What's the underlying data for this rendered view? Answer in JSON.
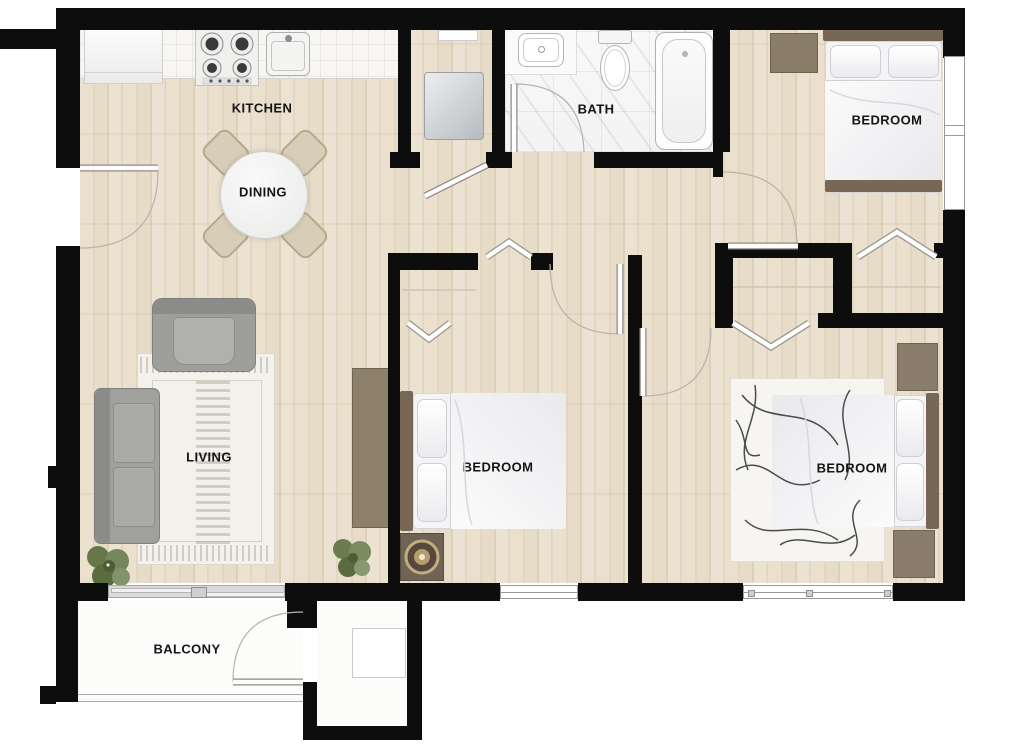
{
  "plan": {
    "type": "apartment-floor-plan",
    "rooms": {
      "kitchen": {
        "label": "KITCHEN"
      },
      "dining": {
        "label": "DINING"
      },
      "bath": {
        "label": "BATH"
      },
      "living": {
        "label": "LIVING"
      },
      "balcony": {
        "label": "BALCONY"
      },
      "bedroom_top": {
        "label": "BEDROOM"
      },
      "bedroom_middle": {
        "label": "BEDROOM"
      },
      "bedroom_right": {
        "label": "BEDROOM"
      }
    },
    "colors": {
      "wall": "#0d0d0d",
      "wood_floor": "#e7dcc8",
      "bath_floor": "#f7f7f8",
      "balcony_floor": "#fcfcfb",
      "upholstery_gray": "#9e9e9c",
      "furniture_brown": "#8a7d68",
      "bedding_white": "#f4f4f6",
      "plant_green": "#6b7d50",
      "background": "#ffffff"
    },
    "fixtures": [
      "refrigerator",
      "gas-stove",
      "kitchen-sink",
      "dining-table",
      "dining-chair",
      "washer",
      "bathroom-sink",
      "toilet",
      "bathtub",
      "sofa",
      "armchair",
      "living-rug",
      "media-console",
      "potted-plant",
      "double-bed",
      "pillow",
      "nightstand",
      "dresser",
      "floor-speaker",
      "bedroom-rug",
      "storage-box",
      "sliding-door",
      "window",
      "door",
      "bifold-closet-door"
    ]
  }
}
